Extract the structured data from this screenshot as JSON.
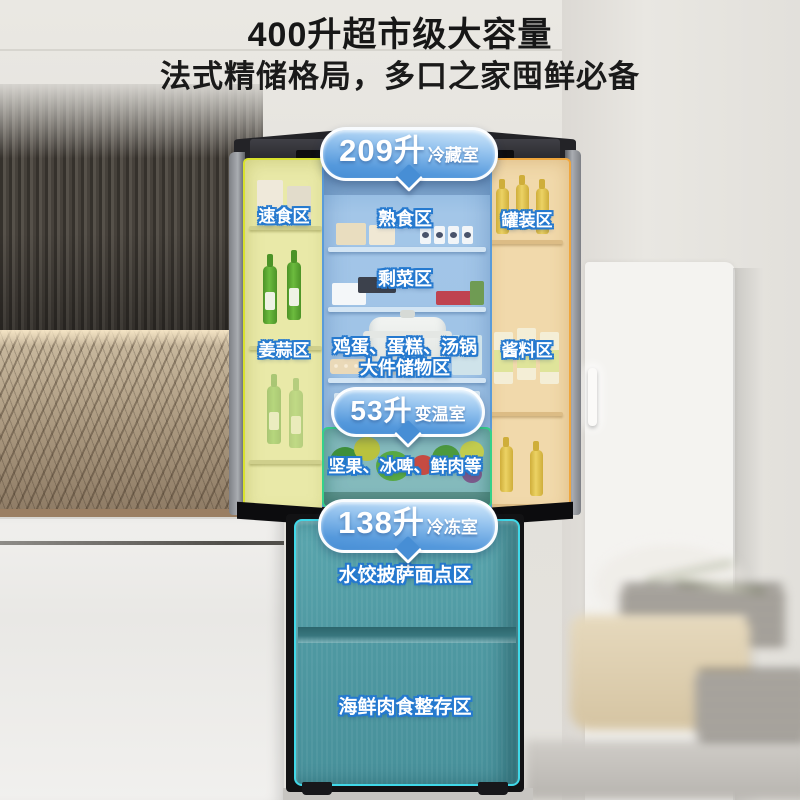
{
  "header": {
    "title": "400升超市级大容量",
    "subtitle": "法式精储格局，多口之家囤鲜必备"
  },
  "badges": {
    "fridge": {
      "value": "209升",
      "label": "冷藏室"
    },
    "variable": {
      "value": "53升",
      "label": "变温室"
    },
    "freezer": {
      "value": "138升",
      "label": "冷冻室"
    }
  },
  "zones": {
    "left_door": {
      "top": "速食区",
      "bottom": "姜蒜区"
    },
    "right_door": {
      "top": "罐装区",
      "bottom": "酱料区"
    },
    "main": {
      "shelf1": "熟食区",
      "shelf2": "剩菜区",
      "shelf3_line1": "鸡蛋、蛋糕、汤锅",
      "shelf3_line2": "大件储物区"
    },
    "variable": {
      "label": "坚果、冰啤、鲜肉等"
    },
    "freezer": {
      "drawer1": "水饺披萨面点区",
      "drawer2": "海鲜肉食整存区"
    }
  },
  "colors": {
    "badge_blue": "#478ed5",
    "label_outline_blue": "#2579cf",
    "left_door_highlight": "#e9e9a8",
    "left_door_border": "#d9e22e",
    "right_door_highlight": "#f1d9ab",
    "right_door_border": "#f0a63c",
    "main_cavity_highlight": "#9cc1e5",
    "main_cavity_border": "#5b9bd8",
    "vartemp_border": "#35d18a",
    "freezer_body": "#4f99a2",
    "freezer_border": "#40d8e8"
  }
}
